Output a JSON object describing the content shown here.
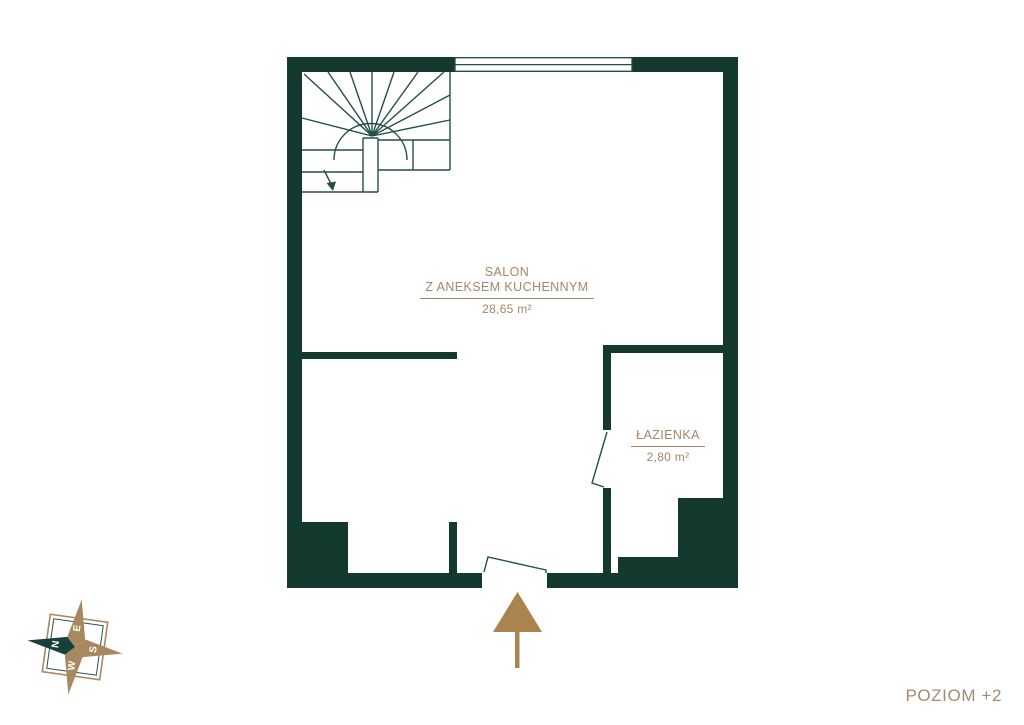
{
  "canvas": {
    "width": 1024,
    "height": 725,
    "background": "#ffffff"
  },
  "palette": {
    "wall": "#143a30",
    "plan_line": "#234f44",
    "room_label": "#a28767",
    "level_label": "#a28a72",
    "arrow": "#a9844f",
    "compass_brown": "#a8895f",
    "compass_green": "#17403a",
    "compass_frame_outer": "#a8895f",
    "compass_frame_inner": "#2b564b",
    "compass_letter": "#ffffff"
  },
  "rooms": [
    {
      "name": "SALON",
      "subtitle": "Z ANEKSEM KUCHENNYM",
      "area": "28,65 m²"
    },
    {
      "name": "ŁAZIENKA",
      "area": "2,80 m²"
    }
  ],
  "level_label": "POZIOM +2",
  "compass": {
    "north": "N",
    "east": "E",
    "south": "S",
    "west": "W"
  }
}
